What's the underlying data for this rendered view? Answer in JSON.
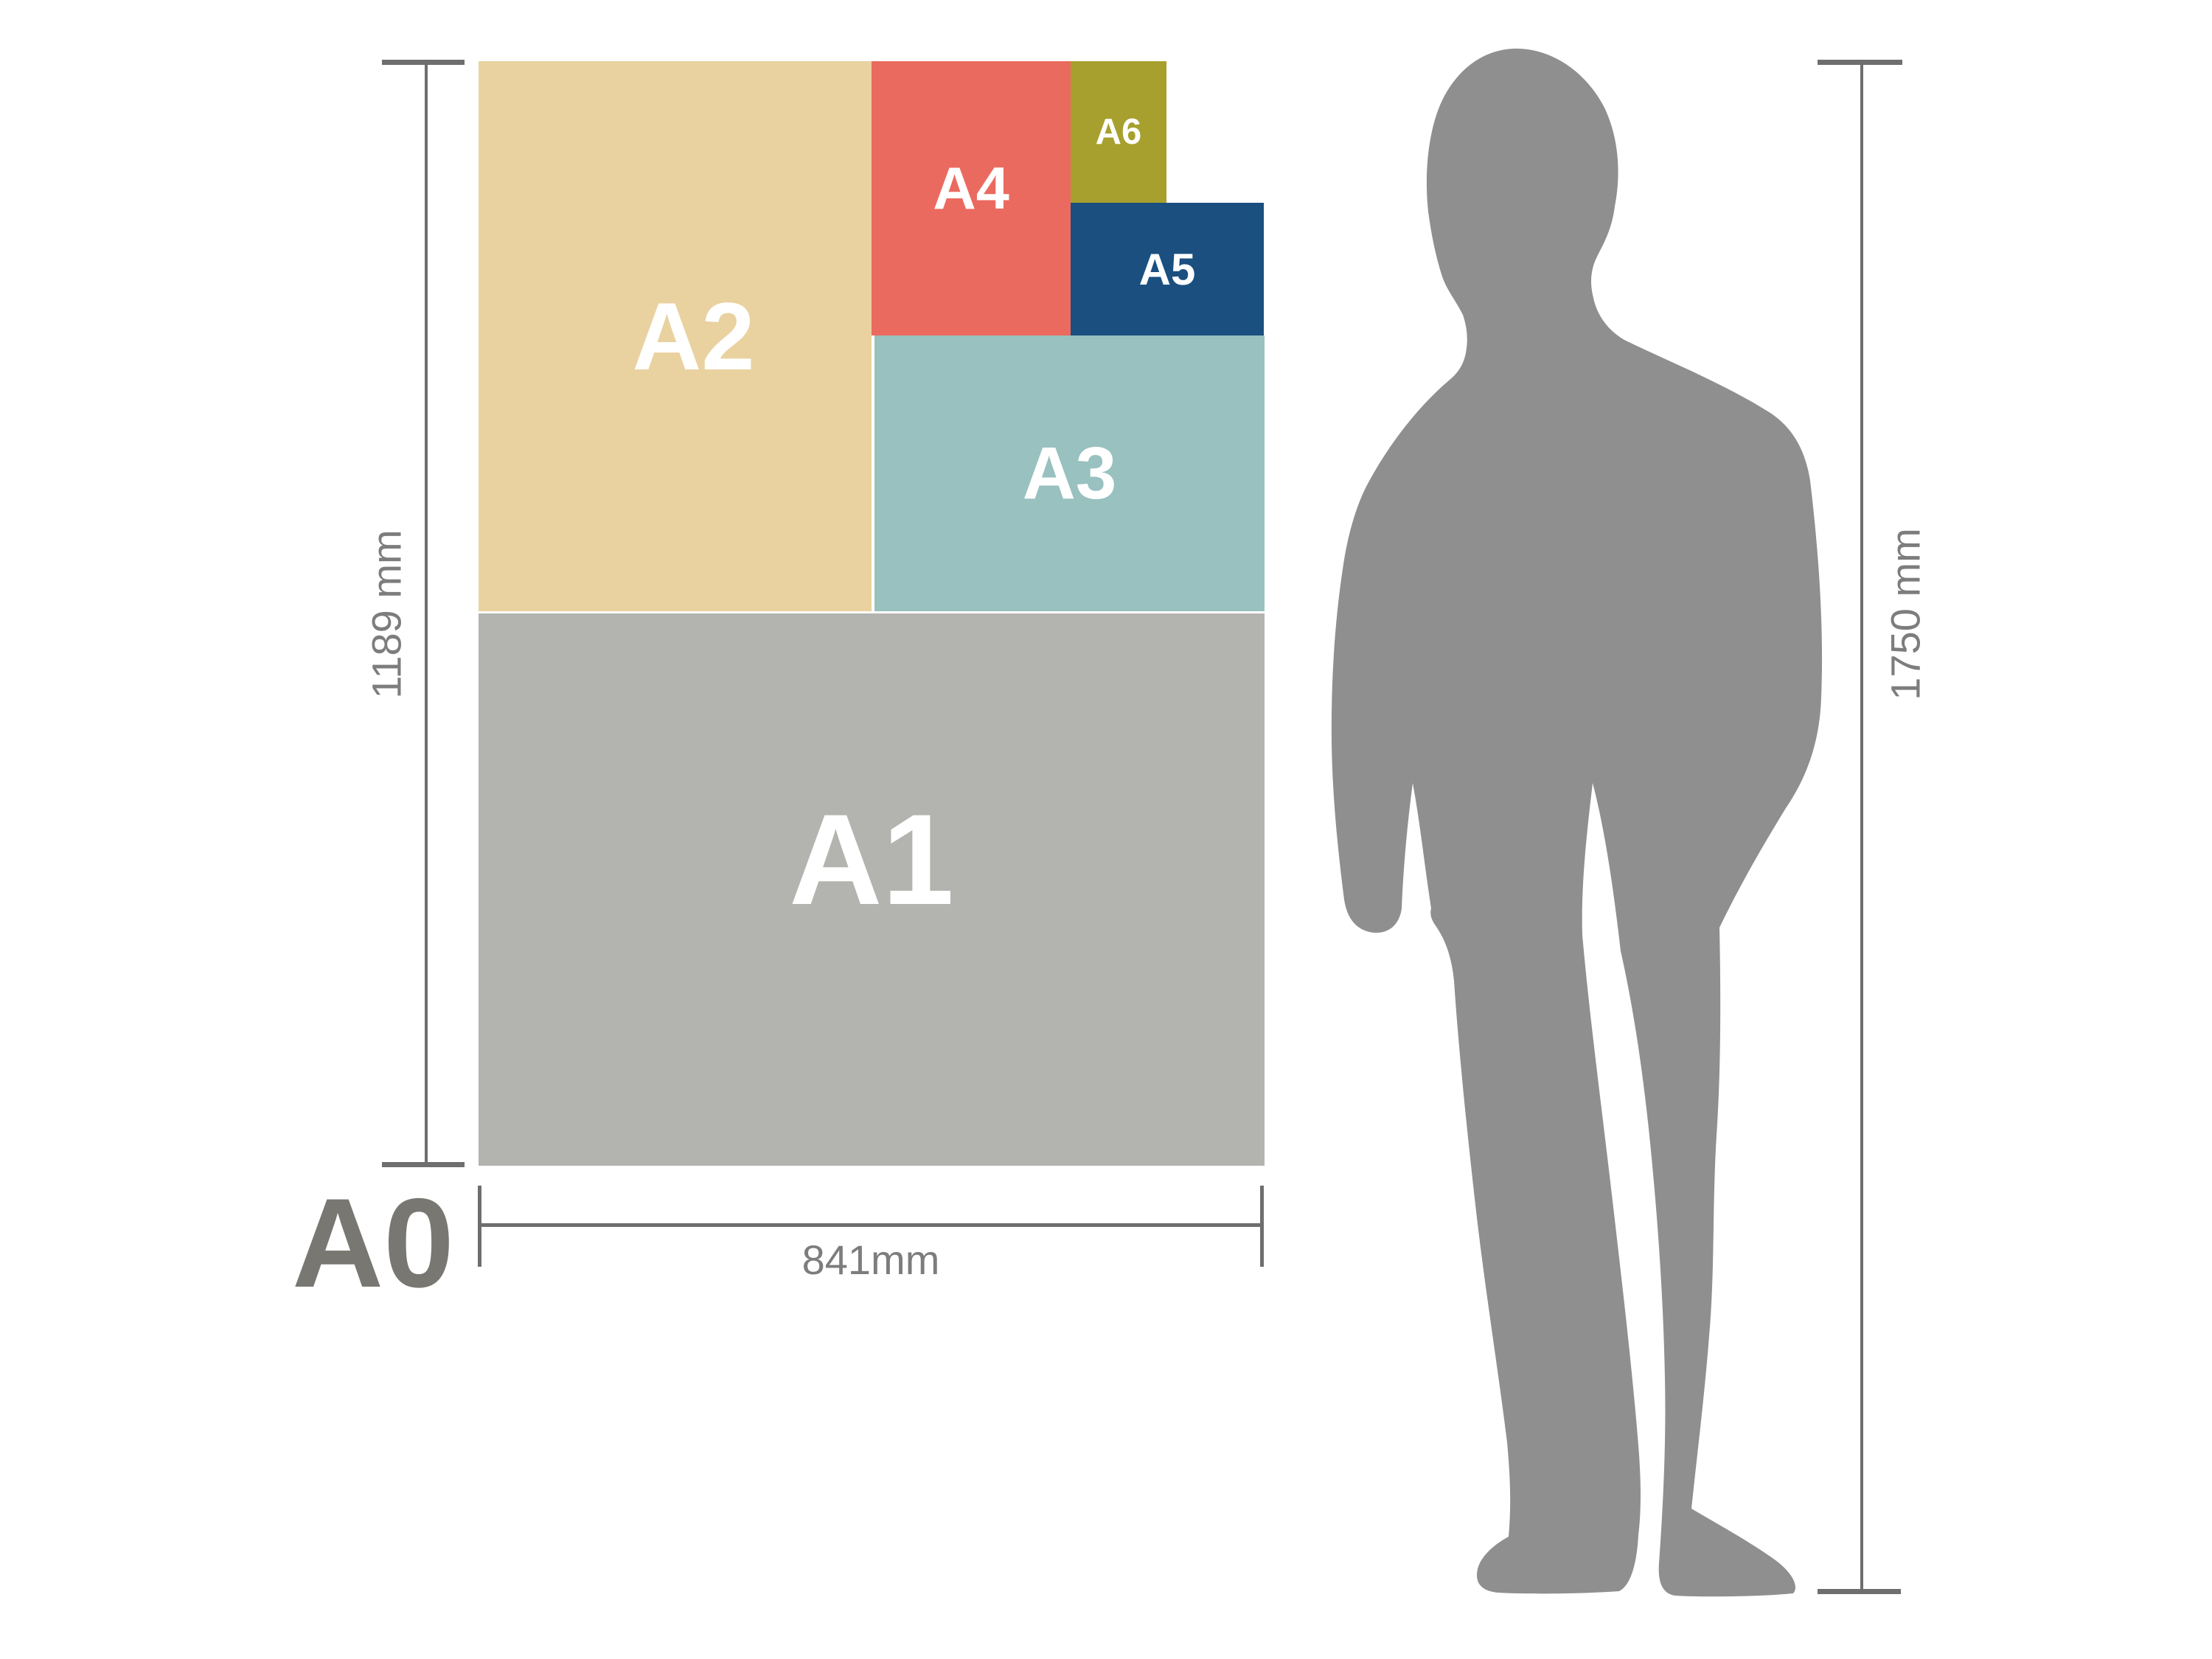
{
  "figure": {
    "a0_label": "A0",
    "papers": {
      "a1": {
        "label": "A1",
        "color": "#b3b3af"
      },
      "a2": {
        "label": "A2",
        "color": "#e9d2a0"
      },
      "a3": {
        "label": "A3",
        "color": "#98c1bf"
      },
      "a4": {
        "label": "A4",
        "color": "#eb6a5f"
      },
      "a5": {
        "label": "A5",
        "color": "#1a4f80"
      },
      "a6": {
        "label": "A6",
        "color": "#a7a02e"
      }
    }
  },
  "dimensions": {
    "paper_height_label": "1189 mm",
    "paper_width_label": "841mm",
    "person_height_label": "1750 mm"
  },
  "person": {
    "color": "#8f8f8f"
  },
  "annotation": {
    "line_color": "#6e6e6e",
    "dim_text_color": "#7d7d7d",
    "a0_text_color": "#787771"
  }
}
